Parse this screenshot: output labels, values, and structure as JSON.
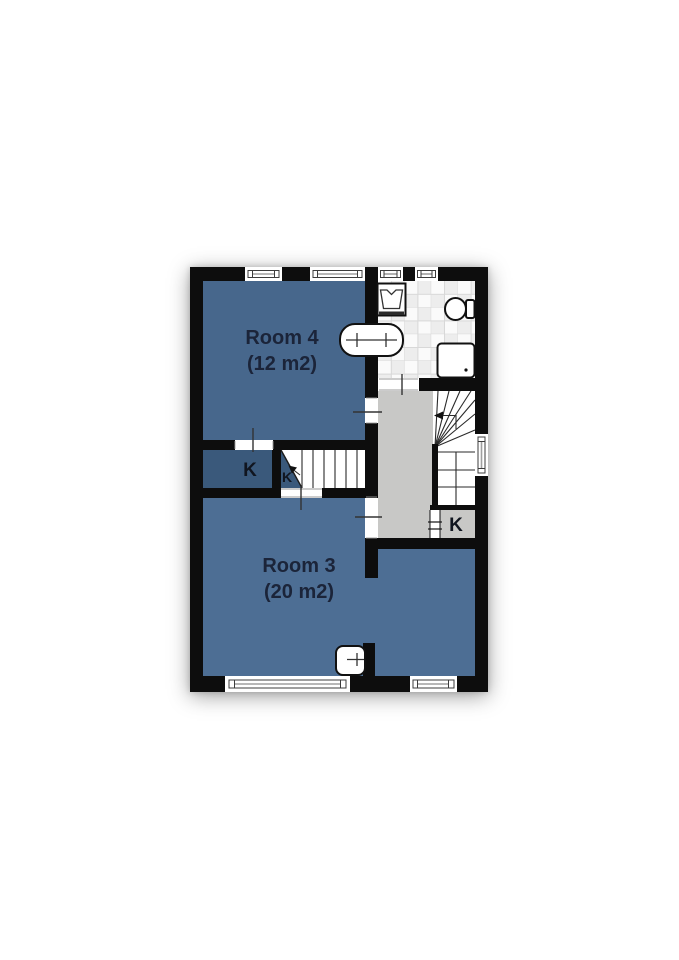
{
  "colors": {
    "wall": "#0d0d0d",
    "room4": "#47678c",
    "room3": "#4d6e94",
    "closet": "#3a597b",
    "landing": "#c8c8c6",
    "tile_alt": "#ededed",
    "tile_line": "#d8d8d8",
    "label": "#1b2439",
    "klabel": "#10151f"
  },
  "rooms": [
    {
      "name": "Room 4",
      "area": "(12 m2)"
    },
    {
      "name": "Room 3",
      "area": "(20 m2)"
    }
  ],
  "closets": [
    {
      "label": "K"
    },
    {
      "label": "K"
    },
    {
      "label": "K"
    }
  ],
  "fixtures": [
    {
      "icon": "washing-machine-icon"
    },
    {
      "icon": "double-sink-icon"
    },
    {
      "icon": "toilet-icon"
    },
    {
      "icon": "shower-icon"
    },
    {
      "icon": "hand-sink-icon"
    },
    {
      "icon": "stairs-up-icon"
    }
  ]
}
